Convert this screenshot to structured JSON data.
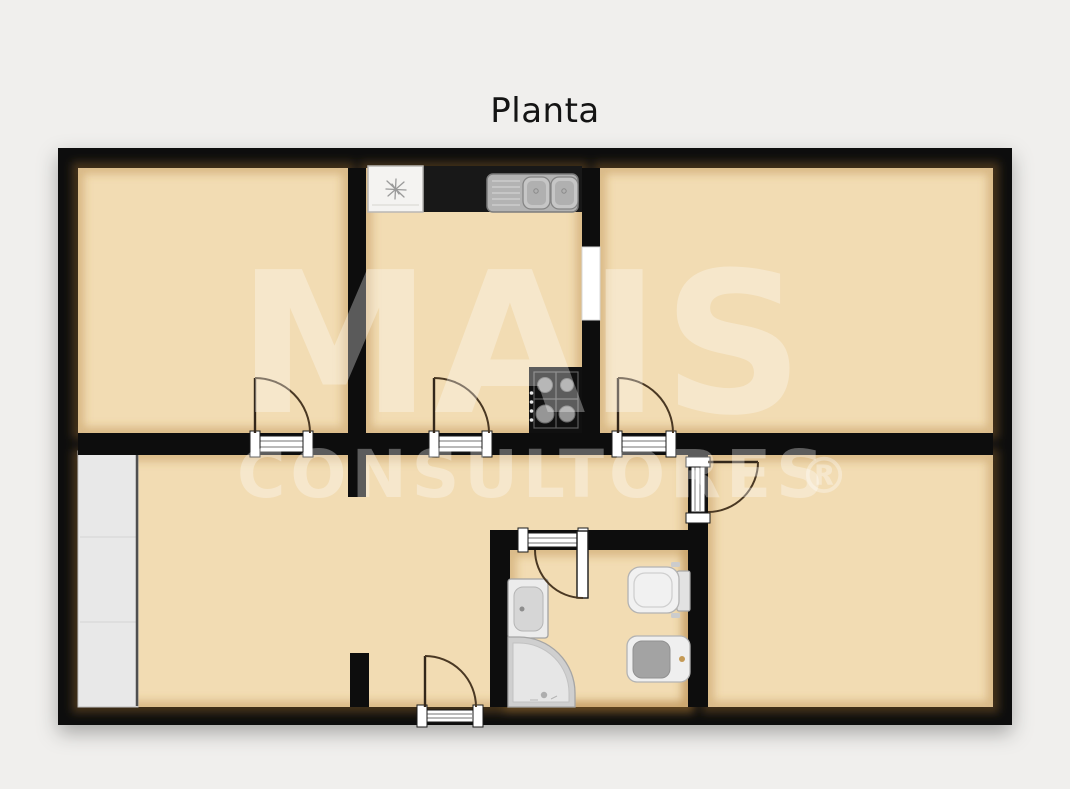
{
  "title": "Planta",
  "watermark": {
    "line1": "MAIS",
    "line2": "CONSULTORES",
    "registered": "®"
  },
  "palette": {
    "page_background": "#f0efed",
    "floor": "#f2dcb3",
    "wall": "#0d0d0d",
    "kitchen_counter": "#181818",
    "appliance_white": "#f4f3f1",
    "sink_steel": "#b3b3b3",
    "fixture_white": "#ededed",
    "fixture_gray": "#a3a3a3",
    "wardrobe_gray": "#e8e8e8",
    "door_arc": "#4a3823",
    "interior_window": "#ffffff",
    "watermark_color": "rgba(255,255,255,0.32)"
  },
  "icons": [
    "fridge-snowflake-icon",
    "kitchen-double-sink-icon",
    "stove-four-burner-icon",
    "wardrobe-icon",
    "interior-window-icon",
    "door-swing-icon",
    "bathroom-sink-icon",
    "corner-shower-icon",
    "toilet-icon",
    "bidet-icon"
  ]
}
